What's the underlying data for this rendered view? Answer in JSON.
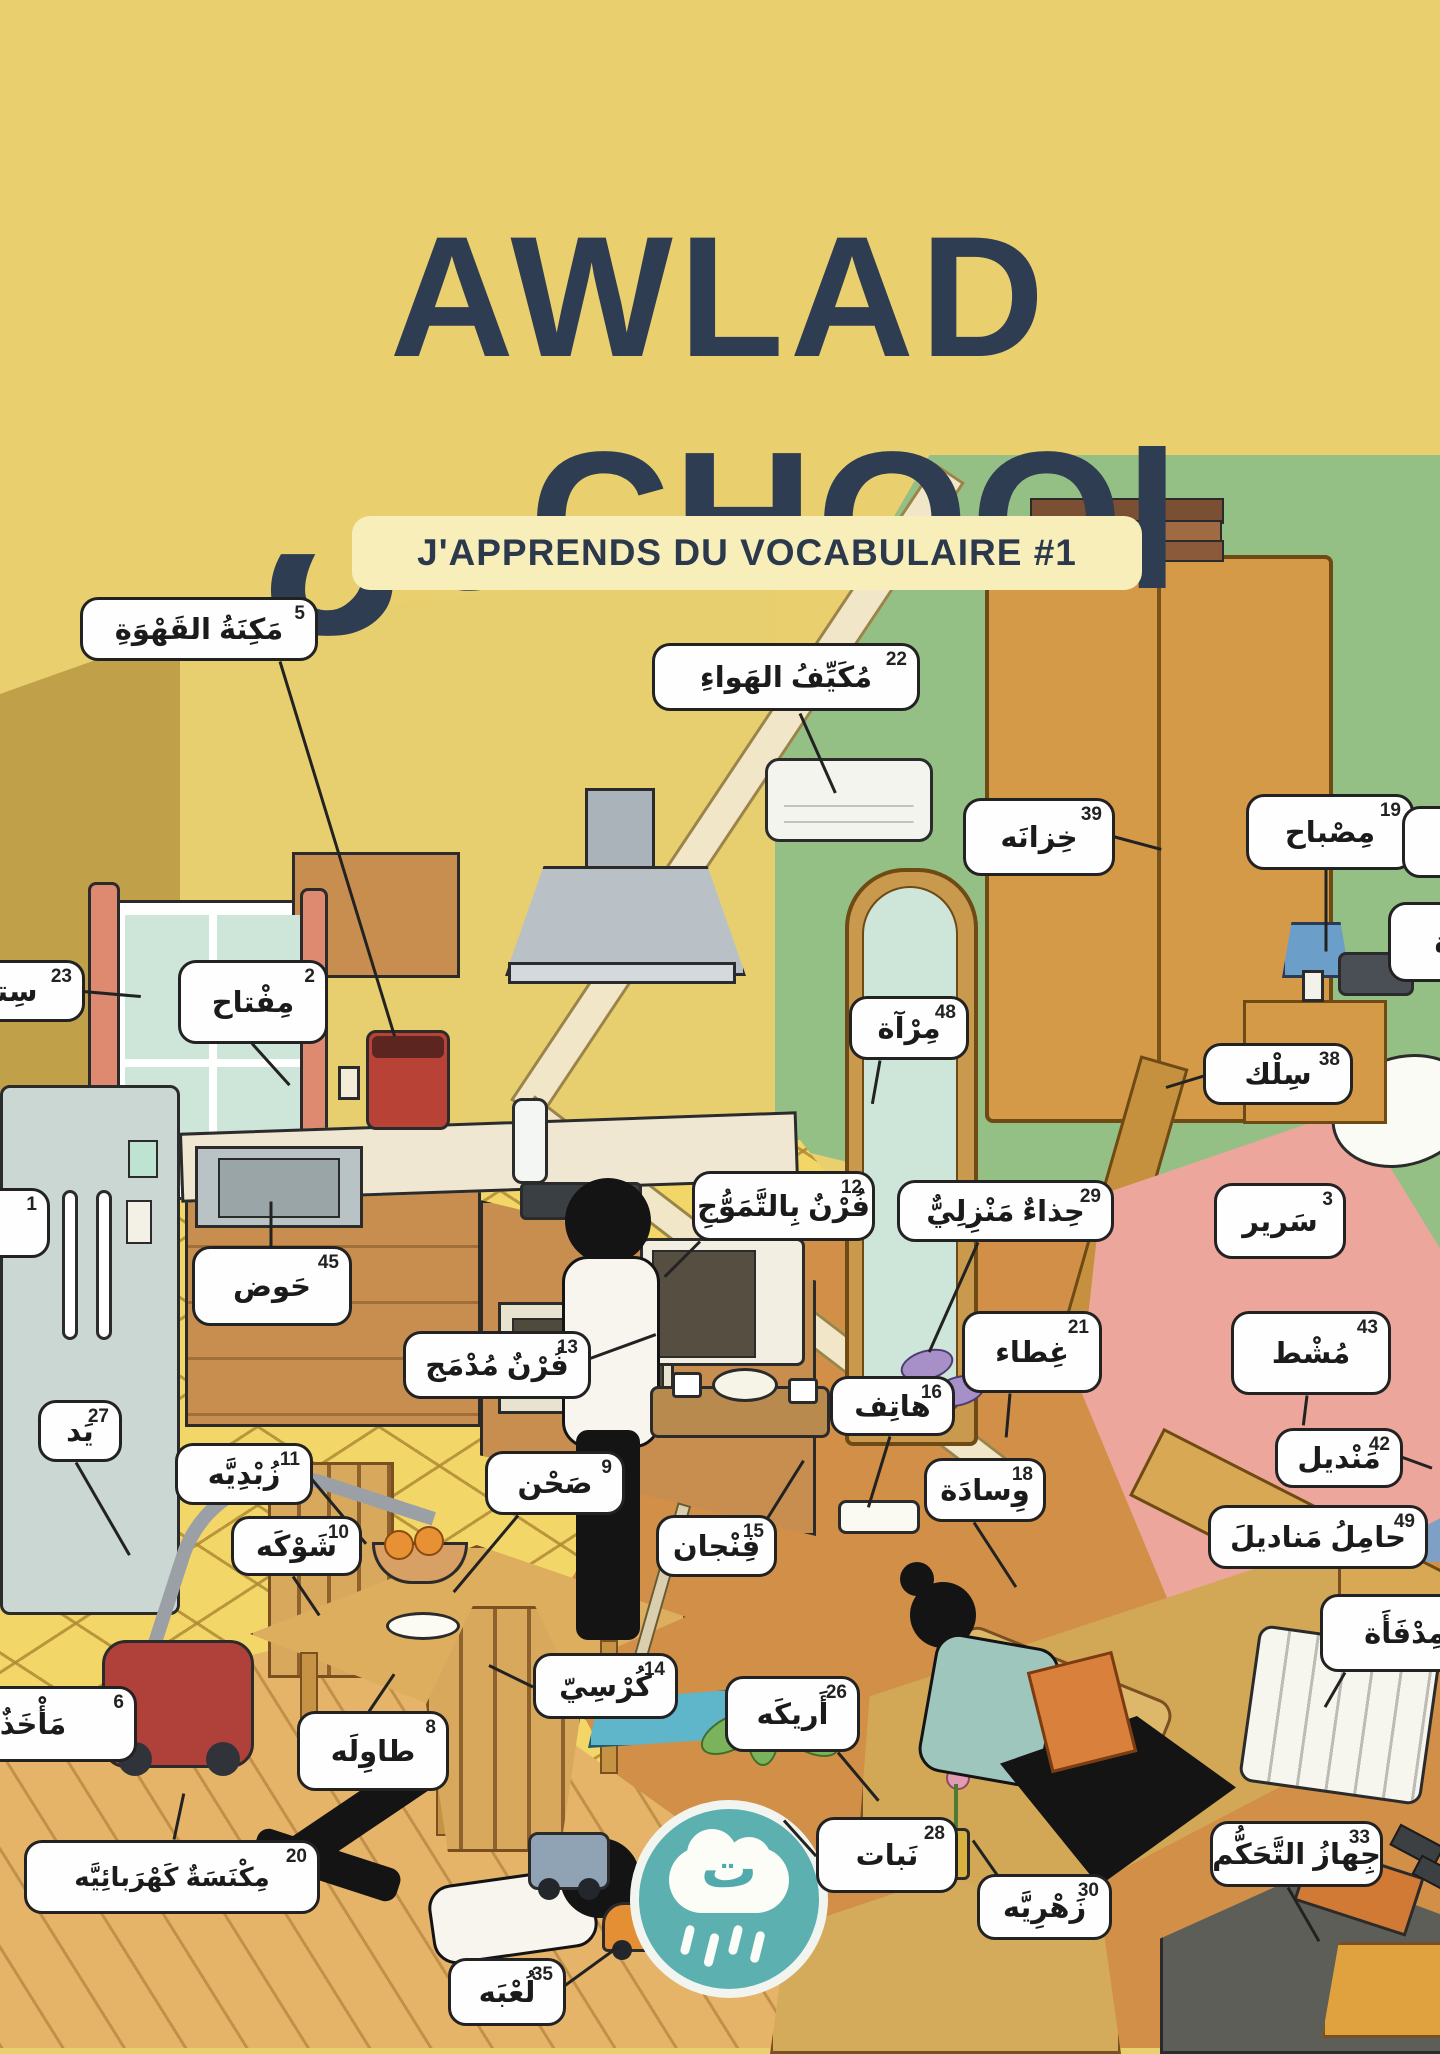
{
  "header": {
    "title_line1": "AWLAD",
    "title_line2": "سCHOOl",
    "subtitle": "J'APPRENDS DU VOCABULAIRE #1"
  },
  "logo": {
    "letter": "ت",
    "icon": "rain-cloud-icon"
  },
  "colors": {
    "page_yellow": "#e9cf6e",
    "title_navy": "#2e3d52",
    "accent_teal": "#5cb0b0",
    "green_wall": "#94bf85",
    "label_border": "#222222",
    "bed_pink": "#eda69b",
    "floor_orange": "#d28f47"
  },
  "labels": [
    {
      "num": "5",
      "text": "مَكِنَةُ القَهْوَةِ",
      "x": 80,
      "y": 597,
      "w": 238,
      "h": 64
    },
    {
      "num": "22",
      "text": "مُكَيِّفُ الهَواءِ",
      "x": 652,
      "y": 643,
      "w": 268,
      "h": 68
    },
    {
      "num": "39",
      "text": "خِزانَه",
      "x": 963,
      "y": 798,
      "w": 152,
      "h": 78
    },
    {
      "num": "19",
      "text": "مِصْباح",
      "x": 1246,
      "y": 794,
      "w": 168,
      "h": 76
    },
    {
      "num": "23",
      "text": "سِتارَة",
      "x": -95,
      "y": 960,
      "w": 180,
      "h": 62
    },
    {
      "num": "2",
      "text": "مِفْتاح",
      "x": 178,
      "y": 960,
      "w": 150,
      "h": 84
    },
    {
      "num": "48",
      "text": "مِرْآة",
      "x": 849,
      "y": 996,
      "w": 120,
      "h": 64
    },
    {
      "num": "38",
      "text": "سِلْك",
      "x": 1203,
      "y": 1043,
      "w": 150,
      "h": 62
    },
    {
      "num": "",
      "text": "",
      "x": 1402,
      "y": 806,
      "w": 100,
      "h": 72
    },
    {
      "num": "",
      "text": "ة",
      "x": 1388,
      "y": 902,
      "w": 110,
      "h": 80
    },
    {
      "num": "1",
      "text": "ثَلّاجَة",
      "x": -135,
      "y": 1188,
      "w": 185,
      "h": 70
    },
    {
      "num": "45",
      "text": "حَوض",
      "x": 192,
      "y": 1246,
      "w": 160,
      "h": 80
    },
    {
      "num": "12",
      "text": "فُرْنٌ بِالتَّمَوُّجِ",
      "x": 692,
      "y": 1171,
      "w": 183,
      "h": 70
    },
    {
      "num": "29",
      "text": "حِذاءٌ مَنْزِلِيٌّ",
      "x": 897,
      "y": 1180,
      "w": 217,
      "h": 62
    },
    {
      "num": "3",
      "text": "سَرير",
      "x": 1214,
      "y": 1183,
      "w": 132,
      "h": 76
    },
    {
      "num": "13",
      "text": "فُرْنٌ مُدْمَج",
      "x": 403,
      "y": 1331,
      "w": 188,
      "h": 68
    },
    {
      "num": "21",
      "text": "غِطاء",
      "x": 962,
      "y": 1311,
      "w": 140,
      "h": 82
    },
    {
      "num": "43",
      "text": "مُشْط",
      "x": 1231,
      "y": 1311,
      "w": 160,
      "h": 84
    },
    {
      "num": "16",
      "text": "هاتِف",
      "x": 830,
      "y": 1376,
      "w": 125,
      "h": 60
    },
    {
      "num": "42",
      "text": "مَنْديل",
      "x": 1275,
      "y": 1428,
      "w": 128,
      "h": 60
    },
    {
      "num": "27",
      "text": "يَد",
      "x": 38,
      "y": 1400,
      "w": 84,
      "h": 62
    },
    {
      "num": "11",
      "text": "زُبْدِيَّه",
      "x": 175,
      "y": 1443,
      "w": 138,
      "h": 62
    },
    {
      "num": "18",
      "text": "وِسادَة",
      "x": 924,
      "y": 1458,
      "w": 122,
      "h": 64
    },
    {
      "num": "49",
      "text": "حامِلُ مَناديلَ",
      "x": 1208,
      "y": 1505,
      "w": 220,
      "h": 64
    },
    {
      "num": "9",
      "text": "صَحْن",
      "x": 485,
      "y": 1451,
      "w": 140,
      "h": 64
    },
    {
      "num": "10",
      "text": "شَوْكَه",
      "x": 231,
      "y": 1516,
      "w": 131,
      "h": 60
    },
    {
      "num": "15",
      "text": "فِنْجان",
      "x": 656,
      "y": 1515,
      "w": 121,
      "h": 62
    },
    {
      "num": "",
      "text": "مِدْفَأَة",
      "x": 1320,
      "y": 1594,
      "w": 170,
      "h": 78
    },
    {
      "num": "14",
      "text": "كُرْسِيّ",
      "x": 533,
      "y": 1653,
      "w": 145,
      "h": 66
    },
    {
      "num": "26",
      "text": "أَريكَه",
      "x": 725,
      "y": 1676,
      "w": 135,
      "h": 76
    },
    {
      "num": "6",
      "text": "مَأْخَذٌ كَهْـ",
      "x": -125,
      "y": 1686,
      "w": 262,
      "h": 76
    },
    {
      "num": "8",
      "text": "طاوِلَه",
      "x": 297,
      "y": 1711,
      "w": 152,
      "h": 80
    },
    {
      "num": "20",
      "text": "مِكْنَسَةٌ كَهْرَبائِيَّه",
      "x": 24,
      "y": 1840,
      "w": 296,
      "h": 74
    },
    {
      "num": "28",
      "text": "نَبات",
      "x": 816,
      "y": 1817,
      "w": 142,
      "h": 76
    },
    {
      "num": "30",
      "text": "زَهْرِيَّه",
      "x": 977,
      "y": 1874,
      "w": 135,
      "h": 66
    },
    {
      "num": "33",
      "text": "جِهازُ التَّحَكُّم",
      "x": 1210,
      "y": 1821,
      "w": 173,
      "h": 66
    },
    {
      "num": "35",
      "text": "لُعْبَه",
      "x": 448,
      "y": 1958,
      "w": 118,
      "h": 68
    }
  ]
}
